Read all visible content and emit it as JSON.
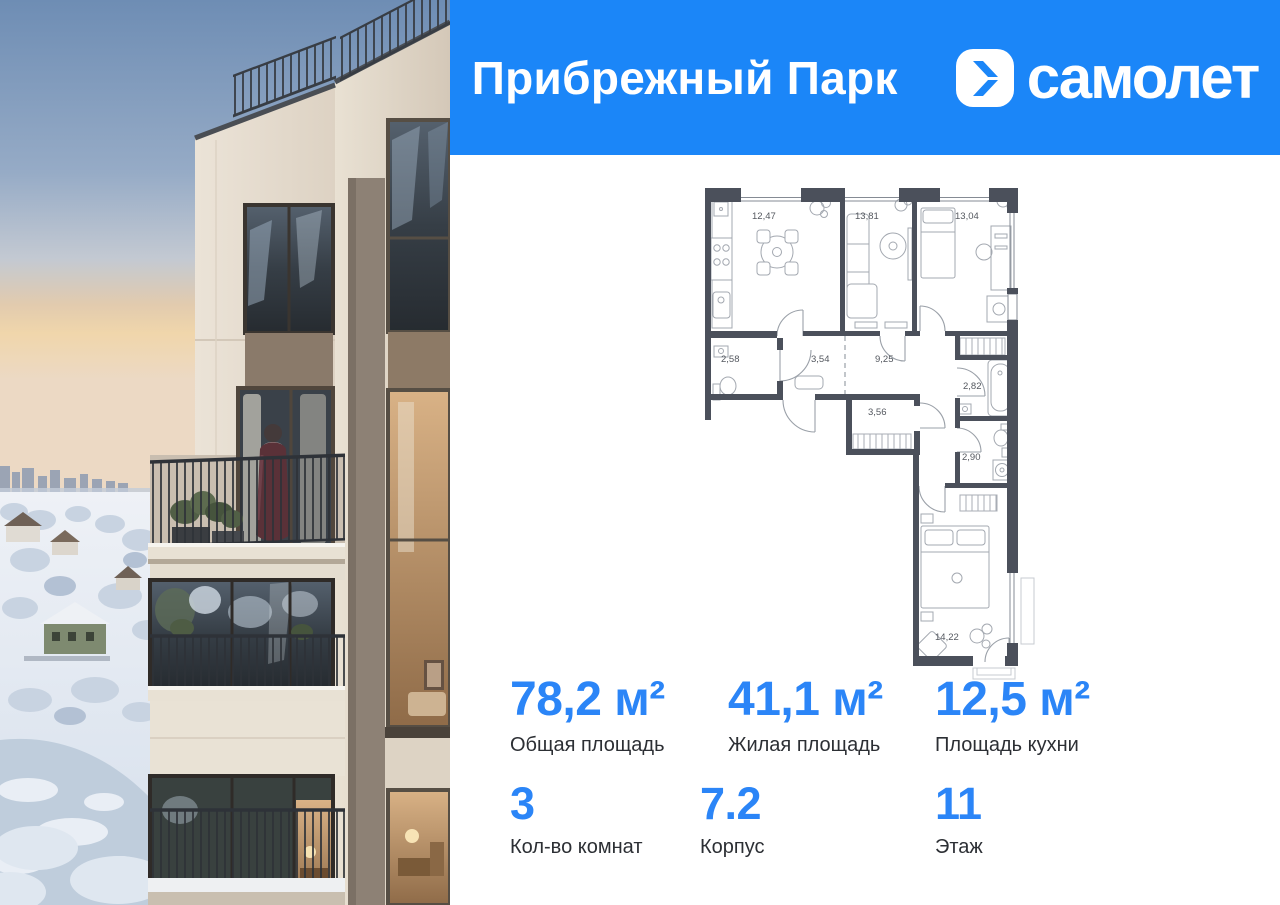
{
  "header": {
    "project_title": "Прибрежный Парк",
    "brand_name": "самолет"
  },
  "floor_plan": {
    "rooms": [
      {
        "name": "kitchen",
        "area": "12,47"
      },
      {
        "name": "living-room",
        "area": "13,81"
      },
      {
        "name": "bedroom-1",
        "area": "13,04"
      },
      {
        "name": "wc",
        "area": "2,58"
      },
      {
        "name": "hallway",
        "area": "3,54"
      },
      {
        "name": "corridor",
        "area": "9,25"
      },
      {
        "name": "bathroom",
        "area": "2,82"
      },
      {
        "name": "storage",
        "area": "3,56"
      },
      {
        "name": "wc-2",
        "area": "2,90"
      },
      {
        "name": "bedroom-2",
        "area": "14,22"
      }
    ]
  },
  "stats": {
    "primary": [
      {
        "value": "78,2 м²",
        "label": "Общая площадь"
      },
      {
        "value": "41,1 м²",
        "label": "Жилая площадь"
      },
      {
        "value": "12,5 м²",
        "label": "Площадь кухни"
      }
    ],
    "secondary": [
      {
        "value": "3",
        "label": "Кол-во комнат"
      },
      {
        "value": "7.2",
        "label": "Корпус"
      },
      {
        "value": "11",
        "label": "Этаж"
      }
    ]
  },
  "colors": {
    "header_blue": "#1b86f8",
    "accent_blue": "#2b85f7",
    "plan_wall": "#4b505b"
  }
}
